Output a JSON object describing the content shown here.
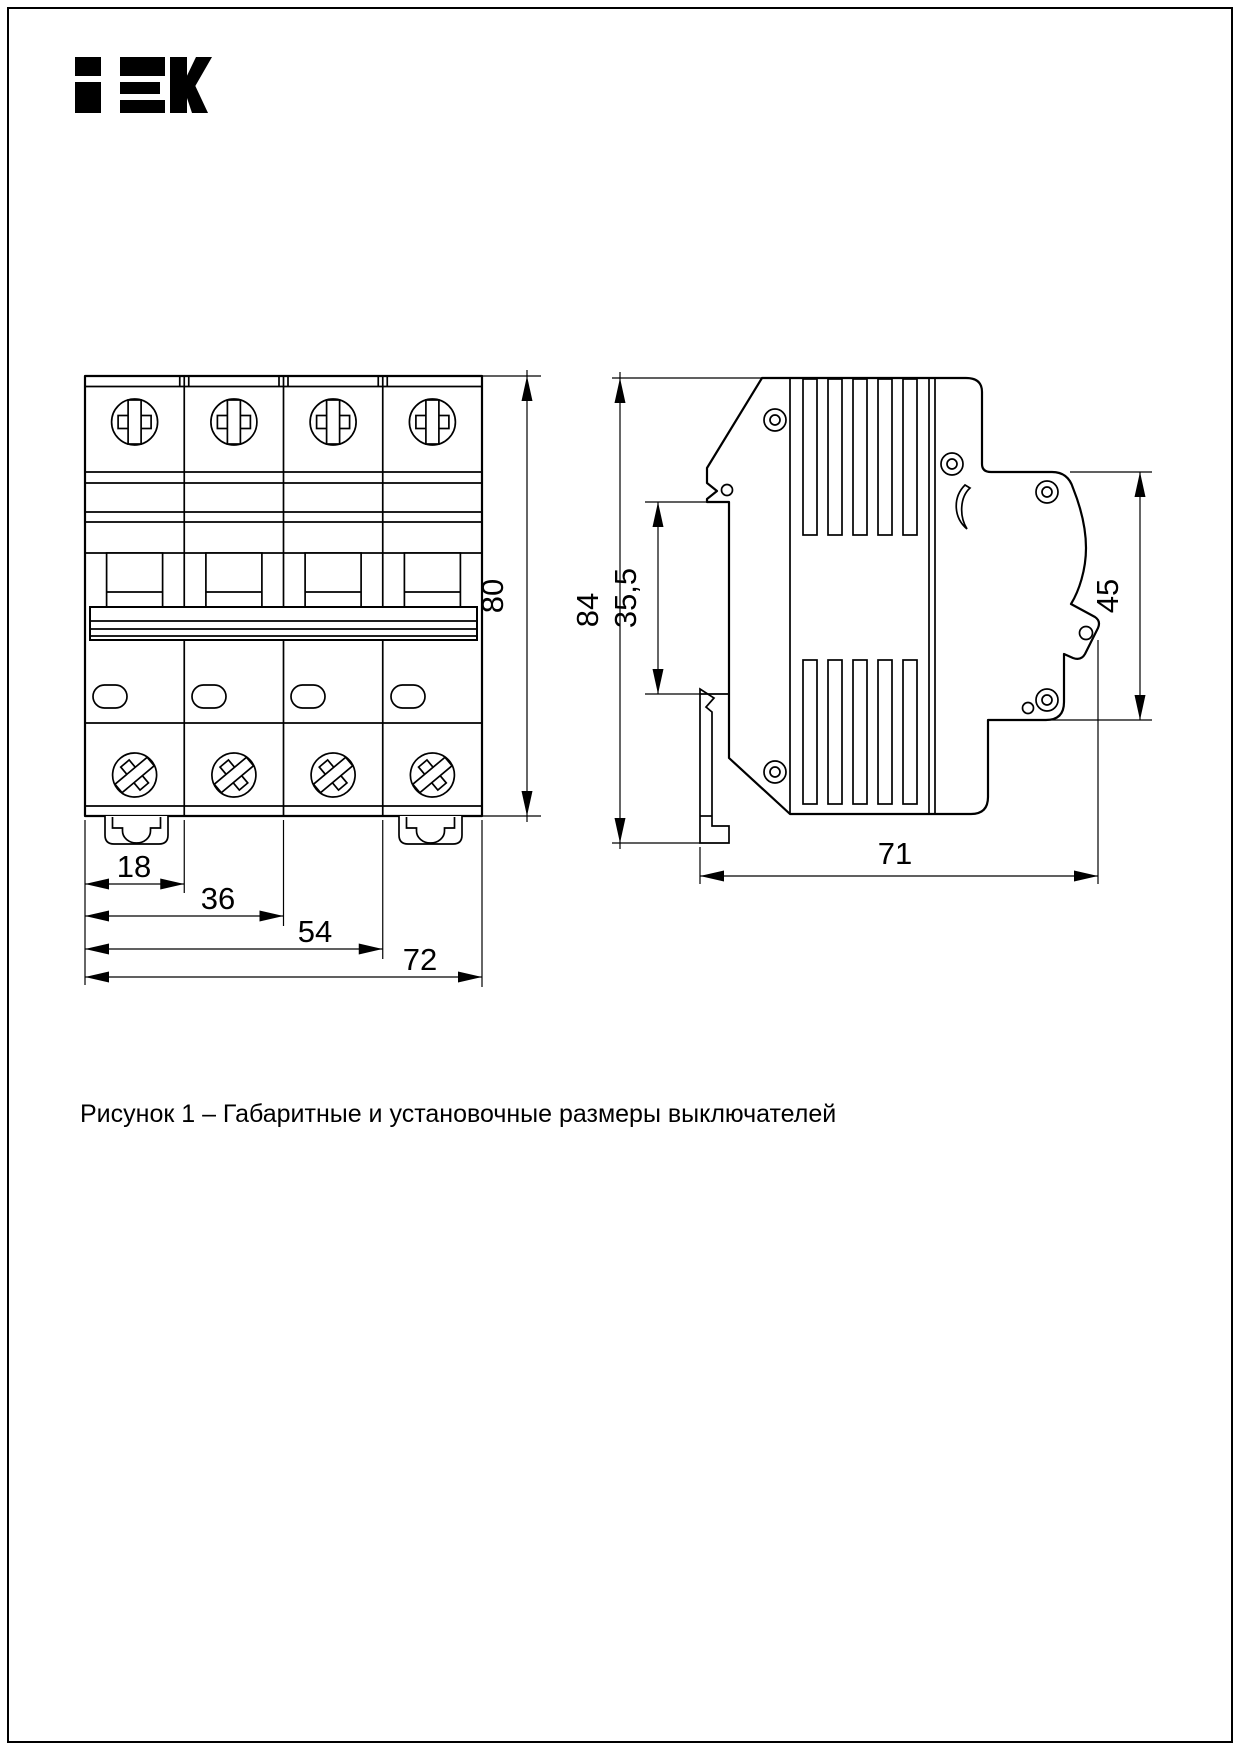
{
  "logo": {
    "brand": "IEK"
  },
  "caption": {
    "text": "Рисунок 1 – Габаритные и установочные размеры выключателей"
  },
  "front_view": {
    "dim_module_width": "18",
    "dim_two_modules": "36",
    "dim_three_modules": "54",
    "dim_total_width": "72",
    "dim_height": "80"
  },
  "side_view": {
    "dim_total_height": "84",
    "dim_rail_seat": "35,5",
    "dim_front_height": "45",
    "dim_depth": "71"
  }
}
